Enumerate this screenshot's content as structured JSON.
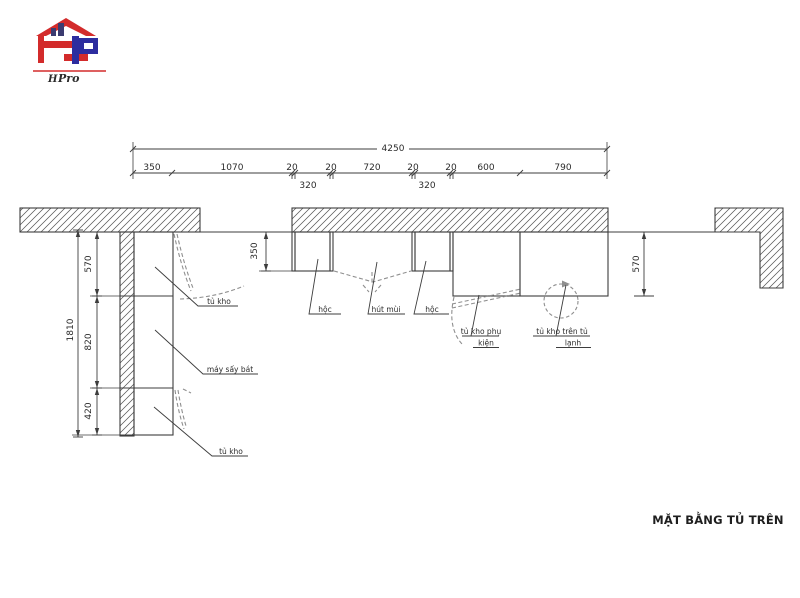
{
  "logo": {
    "h": "H",
    "pro": "Pro"
  },
  "title": "MẶT BẰNG TỦ TRÊN",
  "dims": {
    "overall": "4250",
    "row_above": [
      "350",
      "1070",
      "20",
      "20",
      "720",
      "20",
      "20",
      "600",
      "790"
    ],
    "row_below": [
      "320",
      "320"
    ],
    "left_total": "1810",
    "left_segments": [
      "570",
      "820",
      "420"
    ],
    "mid_height": "350",
    "right_height": "570"
  },
  "labels": {
    "tu_kho_top": "tủ kho",
    "may_say_bat": "máy sấy bát",
    "tu_kho_bottom": "tủ kho",
    "hoc_left": "hộc",
    "hut_mui": "hút mùi",
    "hoc_right": "hộc",
    "tu_kho_phu_1": "tủ kho phụ",
    "tu_kho_phu_2": "kiện",
    "tu_kho_tren_1": "tủ kho trên tủ",
    "tu_kho_tren_2": "lạnh"
  },
  "colors": {
    "line": "#3d3d3d",
    "dash": "#8f8f8f",
    "logo_red": "#d32b2b",
    "logo_blue": "#2d2d9f"
  }
}
